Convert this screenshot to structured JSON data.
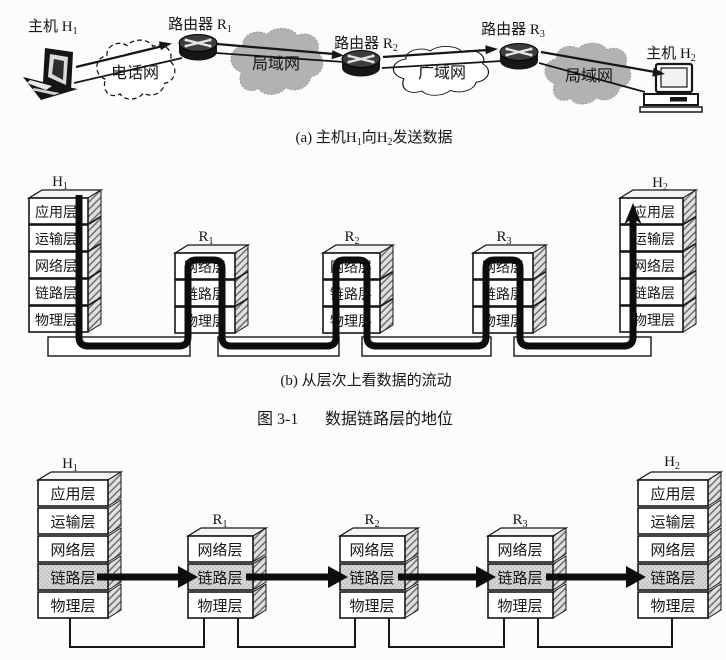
{
  "figure": {
    "caption_a": {
      "pre": "(a) 主机H",
      "sub1": "1",
      "mid": "向H",
      "sub2": "2",
      "post": "发送数据"
    },
    "caption_b": "(b) 从层次上看数据的流动",
    "caption_num": "图 3-1",
    "caption_title": "数据链路层的地位"
  },
  "topology": {
    "host1_label": {
      "base": "主机 H",
      "sub": "1"
    },
    "host2_label": {
      "base": "主机 H",
      "sub": "2"
    },
    "router1_label": {
      "base": "路由器 R",
      "sub": "1"
    },
    "router2_label": {
      "base": "路由器 R",
      "sub": "2"
    },
    "router3_label": {
      "base": "路由器 R",
      "sub": "3"
    },
    "phone_net": "电话网",
    "lan1": "局域网",
    "wan": "广域网",
    "lan2": "局域网"
  },
  "layers": {
    "app": "应用层",
    "trans": "运输层",
    "net": "网络层",
    "link": "链路层",
    "phy": "物理层"
  },
  "nodes": {
    "h1": {
      "base": "H",
      "sub": "1"
    },
    "h2": {
      "base": "H",
      "sub": "2"
    },
    "r1": {
      "base": "R",
      "sub": "1"
    },
    "r2": {
      "base": "R",
      "sub": "2"
    },
    "r3": {
      "base": "R",
      "sub": "3"
    }
  },
  "colors": {
    "cloud_gray": "#b2b2b2",
    "link_layer_shade": "#d7d7d7",
    "flow_line": "#0d0d0d",
    "ink": "#161616"
  }
}
